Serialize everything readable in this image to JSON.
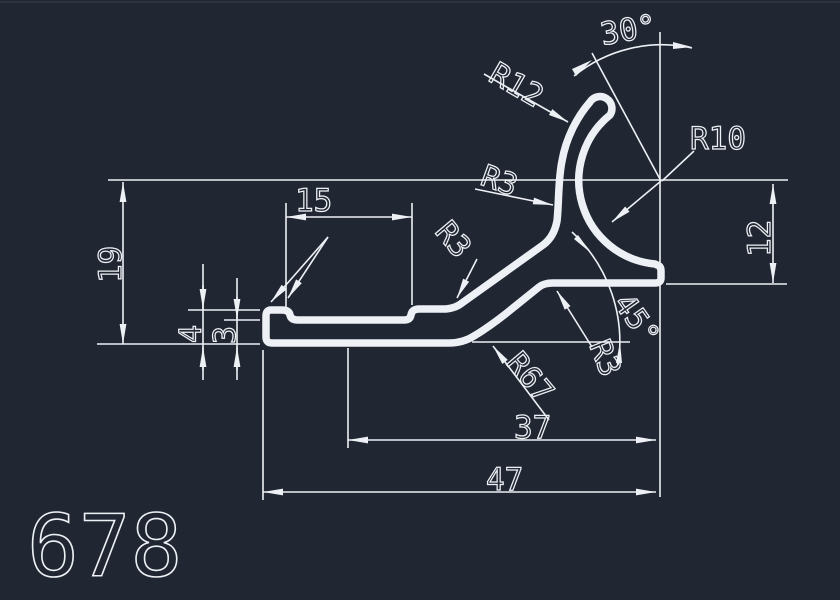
{
  "drawing": {
    "part_number": "678",
    "background_color": "#212633",
    "line_color": "#edf0f4",
    "labels": {
      "angle_top": "30°",
      "radius_hook_outer": "R12",
      "radius_hook_inner": "R10",
      "radius_fillet_upper": "R3",
      "radius_fillet_inner": "R3",
      "radius_fillet_web": "R3",
      "angle_web": "45°",
      "radius_web_curve": "R67",
      "width_slot": "15",
      "height_overall": "19",
      "thickness_lip": "4",
      "thickness_base": "3",
      "height_flange": "12",
      "width_inner_span": "37",
      "width_overall": "47"
    }
  }
}
